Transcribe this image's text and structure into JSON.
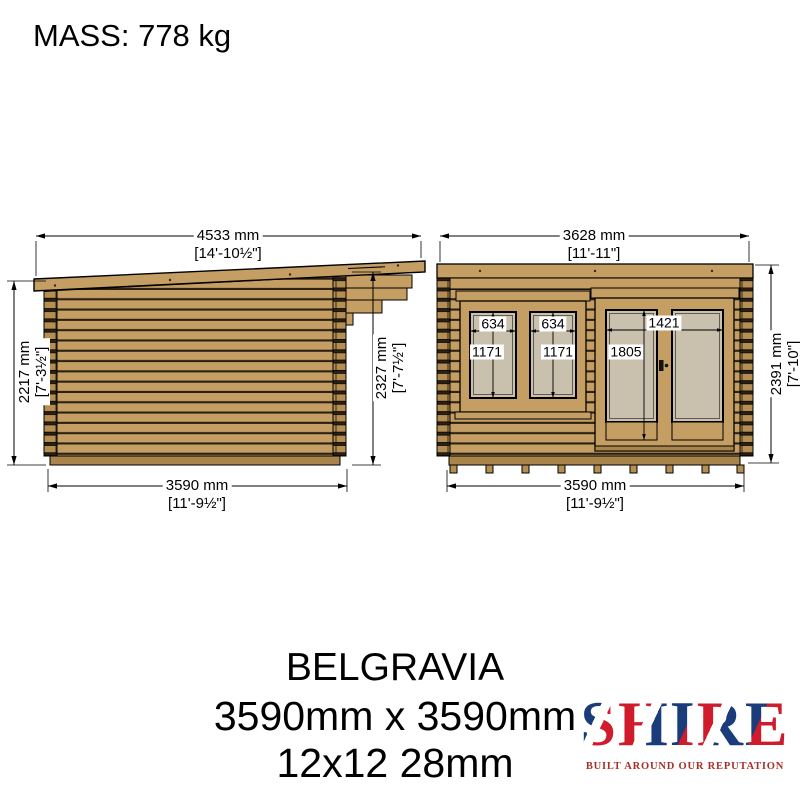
{
  "mass_label": "MASS: 778 kg",
  "side_view": {
    "width_top": "4533 mm",
    "width_top_ft": "[14'-10½\"]",
    "height_left": "2217 mm",
    "height_left_ft": "[7'-3½\"]",
    "height_right": "2327 mm",
    "height_right_ft": "[7'-7½\"]",
    "width_bottom": "3590 mm",
    "width_bottom_ft": "[11'-9½\"]"
  },
  "front_view": {
    "width_top": "3628 mm",
    "width_top_ft": "[11'-11\"]",
    "height_right": "2391 mm",
    "height_right_ft": "[7'-10\"]",
    "width_bottom": "3590 mm",
    "width_bottom_ft": "[11'-9½\"]",
    "window_pane1_width": "634",
    "window_pane2_width": "634",
    "window_pane1_height": "1171",
    "window_pane2_height": "1171",
    "door_width": "1421",
    "door_height": "1805"
  },
  "title_block": {
    "name": "BELGRAVIA",
    "size": "3590mm x 3590mm",
    "spec": "12x12 28mm"
  },
  "logo": {
    "brand": "SHIRE",
    "tagline": "BUILT AROUND OUR REPUTATION"
  },
  "colors": {
    "wood": "#c59e63",
    "wood2": "#b58e52",
    "wood3": "#a9854c",
    "groove": "#2a2014",
    "glass": "#c9c0ae",
    "line": "#000000",
    "flag_blue": "#1b3c7a",
    "flag_red": "#cf1b2b",
    "tagline": "#a8302a"
  }
}
